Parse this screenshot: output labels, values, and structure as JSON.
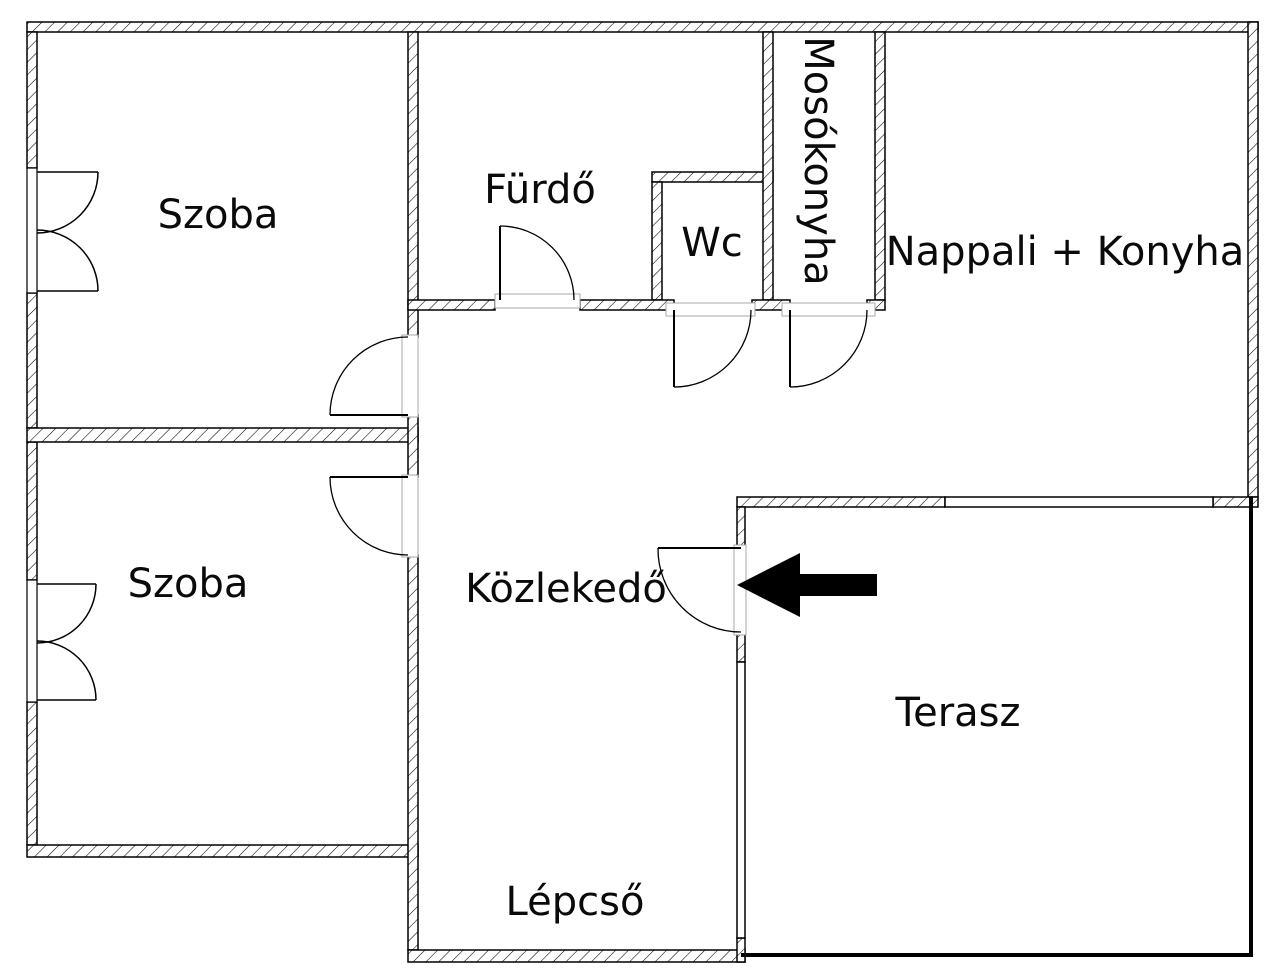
{
  "plan": {
    "type": "floor-plan",
    "background_color": "#ffffff",
    "line_color": "#000000",
    "rooms": [
      {
        "id": "szoba-top",
        "label": "Szoba"
      },
      {
        "id": "furdo",
        "label": "Fürdő"
      },
      {
        "id": "wc",
        "label": "Wc"
      },
      {
        "id": "mosokonyha",
        "label": "Mosókonyha"
      },
      {
        "id": "nappali-konyha",
        "label": "Nappali + Konyha"
      },
      {
        "id": "szoba-bottom",
        "label": "Szoba"
      },
      {
        "id": "kozlekedo",
        "label": "Közlekedő"
      },
      {
        "id": "terasz",
        "label": "Terasz"
      },
      {
        "id": "lepcso",
        "label": "Lépcső"
      }
    ],
    "entrance_arrow": {
      "direction": "left",
      "color": "#000000"
    }
  }
}
